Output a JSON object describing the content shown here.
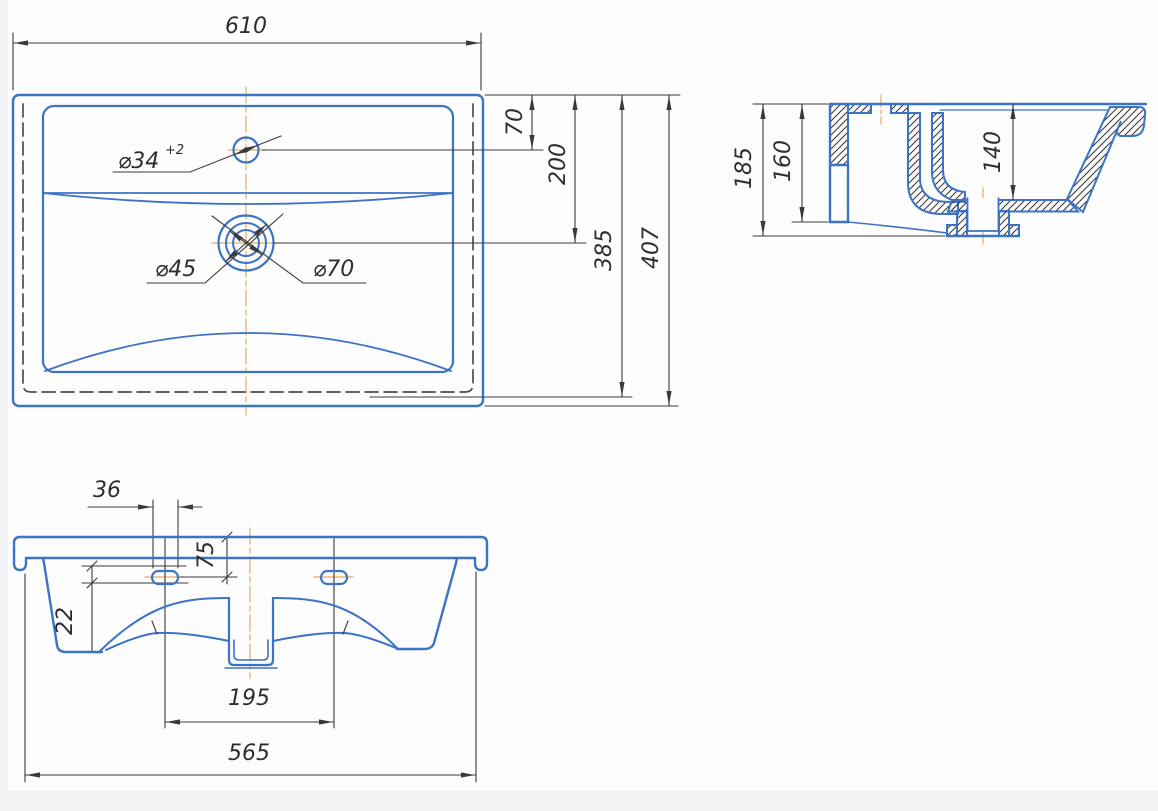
{
  "drawing_title": "washbasin dimensioned drawing",
  "colors": {
    "object_line": "#3c73c4",
    "dimension_line": "#3a3a3a",
    "hidden_line": "#4d4d4d",
    "centerline": "#e2ab65",
    "hatch": "#333333",
    "background": "#fdfdfd"
  },
  "dims": {
    "width_top": "610",
    "faucet_offset": "70",
    "drain_offset": "200",
    "basin_back": "385",
    "depth": "407",
    "faucet_dia": "⌀34",
    "faucet_tol": "+2",
    "drain_dia_inner": "⌀45",
    "drain_dia_outer": "⌀70",
    "side_height": "185",
    "apron_height": "160",
    "bowl_depth": "140",
    "slot_width": "36",
    "slot_offset": "75",
    "slot_height": "22",
    "holes_span": "195",
    "base_width": "565"
  }
}
